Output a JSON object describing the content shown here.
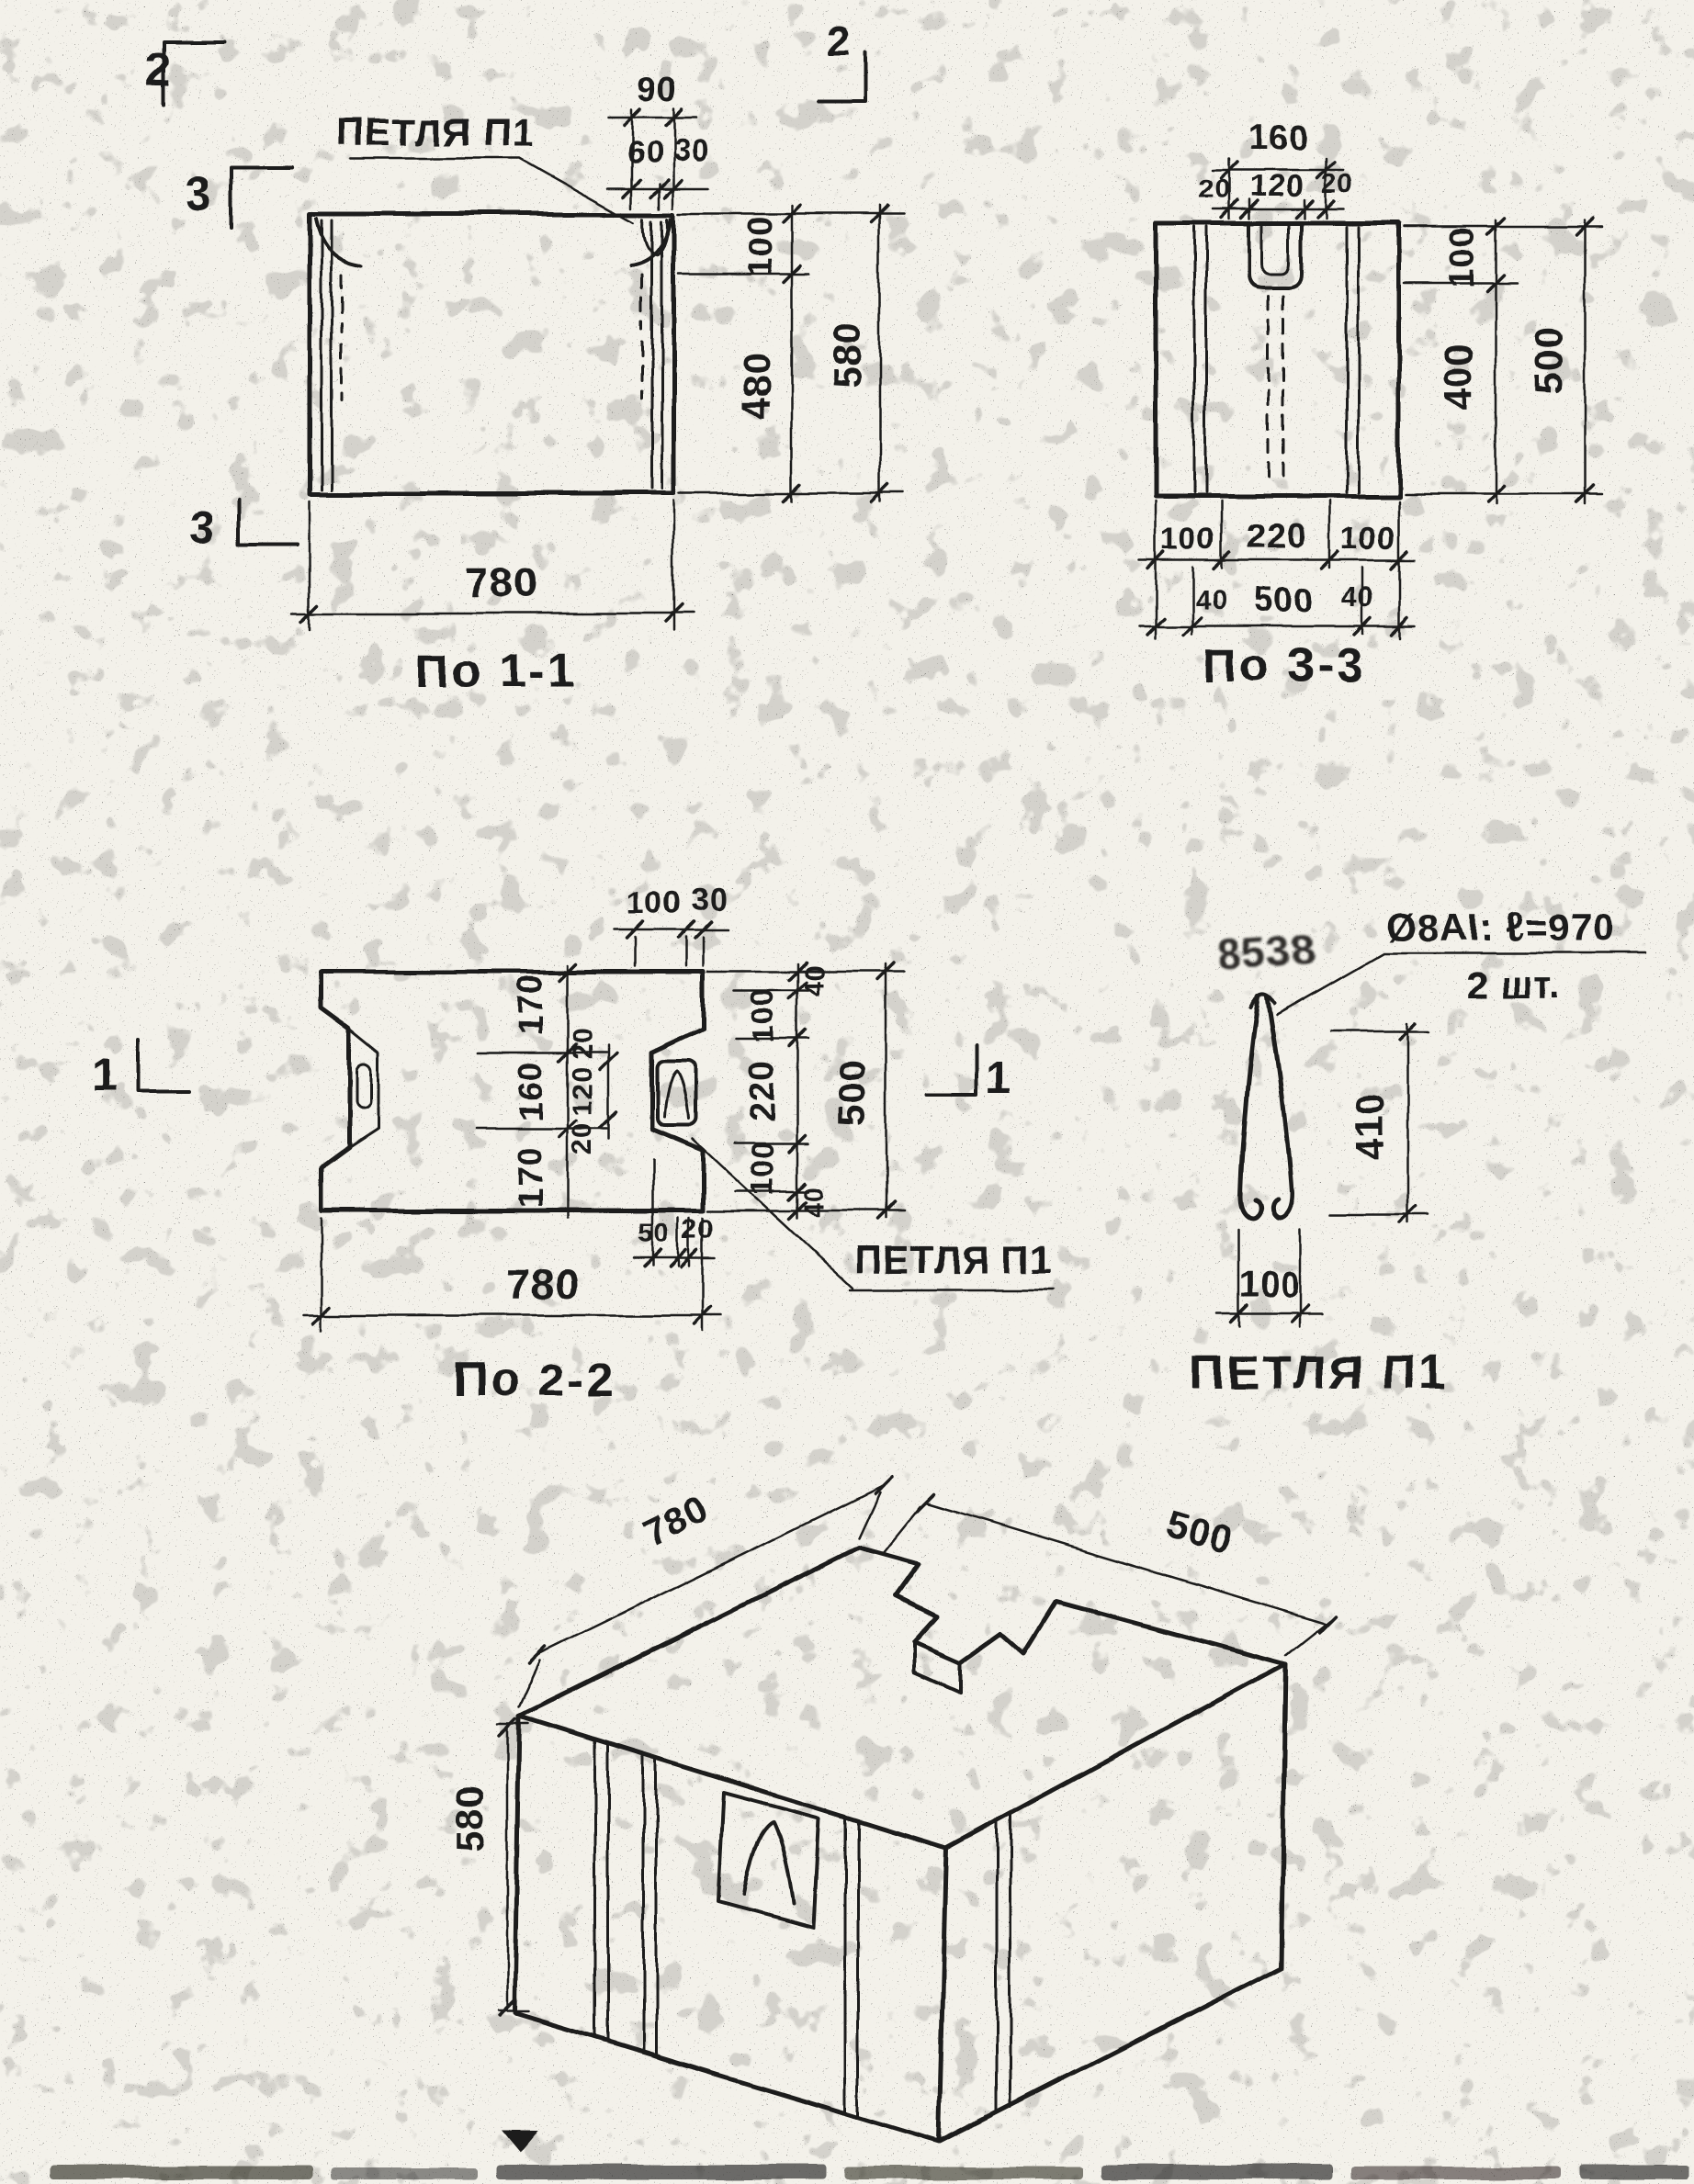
{
  "colors": {
    "paper": "#f3f1ea",
    "ink": "#1d1c1a"
  },
  "section_marks": {
    "s2": "2",
    "s3": "3",
    "s1": "1"
  },
  "view_1_1": {
    "title": "По 1-1",
    "loop_callout": "ПЕТЛЯ П1",
    "dims": {
      "top_overall": "90",
      "top_left": "60",
      "top_right": "30",
      "right_upper": "100",
      "right_lower": "480",
      "right_overall": "580",
      "bottom_overall": "780"
    }
  },
  "view_3_3": {
    "title": "По 3-3",
    "dims": {
      "top_overall": "160",
      "top_segments": [
        "20",
        "120",
        "20"
      ],
      "right_upper": "100",
      "right_lower": "400",
      "right_overall": "500",
      "bottom_segments": [
        "100",
        "220",
        "100"
      ],
      "bottom_left_end": "40",
      "bottom_overall": "500",
      "bottom_right_end": "40"
    }
  },
  "view_2_2": {
    "title": "По 2-2",
    "loop_callout": "ПЕТЛЯ П1",
    "dims": {
      "top_width": "100",
      "top_offset": "30",
      "left_chain": [
        "170",
        "160",
        "170"
      ],
      "notch_chain": [
        "20",
        "120",
        "20"
      ],
      "right_chain": [
        "40",
        "100",
        "220",
        "100",
        "40"
      ],
      "right_overall": "500",
      "bottom_small": [
        "50",
        "20"
      ],
      "bottom_overall": "780"
    }
  },
  "loop_detail": {
    "title": "ПЕТЛЯ П1",
    "callout_spec": "Ø8АI: ℓ=970",
    "callout_qty": "2 шт.",
    "stamp_text": "8538",
    "dims": {
      "height": "410",
      "width": "100"
    }
  },
  "isometric": {
    "dims": {
      "length": "780",
      "depth": "500",
      "height": "580"
    }
  }
}
